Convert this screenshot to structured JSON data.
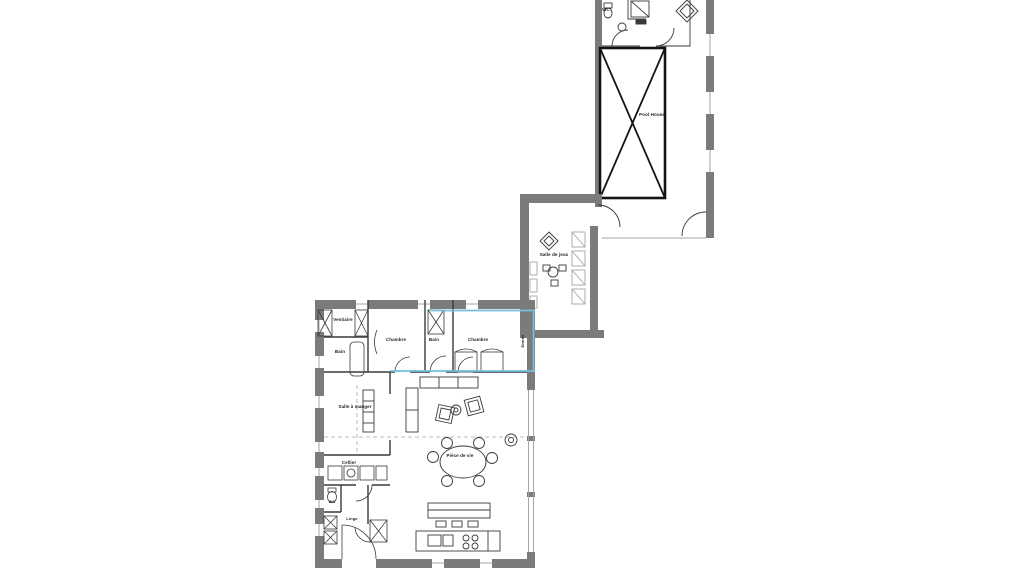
{
  "document": {
    "type": "floor-plan",
    "description": "Architectural floor plan with pool house wing, game room and main house"
  },
  "colors": {
    "background": "#ffffff",
    "wall_gray": "#7b7b7b",
    "line_dark": "#3a3a3a",
    "line_light": "#a6a6a6",
    "highlight_blue": "#74bede",
    "pool_black": "#141414",
    "text": "#1c1c1c"
  },
  "rooms": [
    {
      "id": "wc-pool-house",
      "label": "WC",
      "x": 606,
      "y": 10,
      "size": 4.5
    },
    {
      "id": "pool-house",
      "label": "Pool House",
      "x": 652,
      "y": 115,
      "size": 4.5
    },
    {
      "id": "salle-de-jeux",
      "label": "Salle de jeux",
      "x": 554,
      "y": 255,
      "size": 4.5
    },
    {
      "id": "vestiaire",
      "label": "Vestiaire",
      "x": 343,
      "y": 320,
      "size": 4.5
    },
    {
      "id": "chambre-1",
      "label": "Chambre",
      "x": 396,
      "y": 340,
      "size": 4.5
    },
    {
      "id": "bain-2",
      "label": "Bain",
      "x": 434,
      "y": 340,
      "size": 4.5
    },
    {
      "id": "chambre-2",
      "label": "Chambre",
      "x": 478,
      "y": 340,
      "size": 4.5
    },
    {
      "id": "bain-1",
      "label": "Bain",
      "x": 340,
      "y": 352,
      "size": 4.5
    },
    {
      "id": "entree",
      "label": "Entrée",
      "x": 523,
      "y": 341,
      "rot": -90,
      "size": 4
    },
    {
      "id": "salle-a-manger",
      "label": "Salle à manger",
      "x": 355,
      "y": 407,
      "size": 4.5
    },
    {
      "id": "piece-de-vie",
      "label": "Pièce de vie",
      "x": 460,
      "y": 456,
      "size": 4.5
    },
    {
      "id": "cellier",
      "label": "Cellier",
      "x": 349,
      "y": 463,
      "size": 4.5
    },
    {
      "id": "wc-main",
      "label": "WC",
      "x": 332,
      "y": 502,
      "size": 4
    },
    {
      "id": "linge",
      "label": "Linge",
      "x": 352,
      "y": 519,
      "size": 4
    }
  ]
}
